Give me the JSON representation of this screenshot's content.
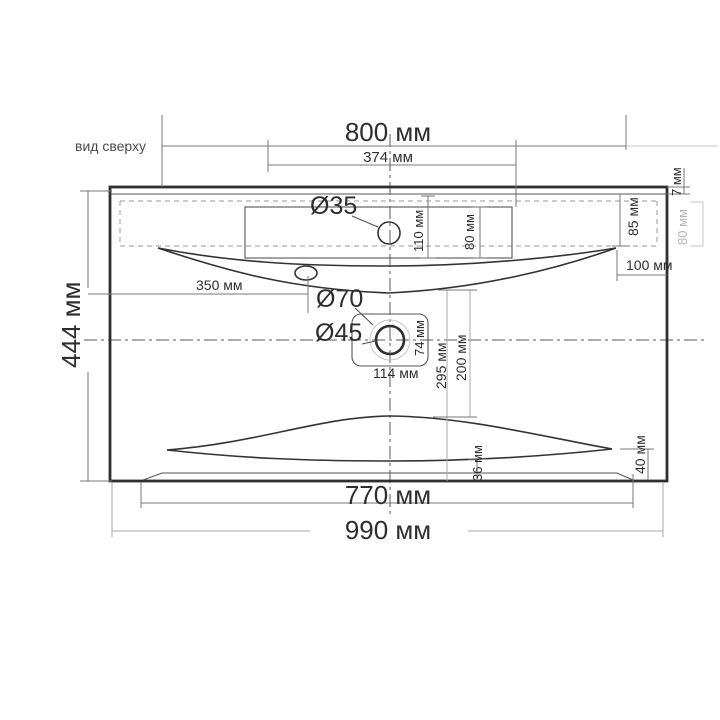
{
  "drawing": {
    "view_label": "вид сверху",
    "type": "washbasin top-view technical drawing",
    "colors": {
      "line_dark": "#2f2f2f",
      "line_muted": "#9a9a9a",
      "dim_gray_text": "#b5b5b5",
      "background": "#ffffff"
    }
  },
  "dimensions": {
    "top_width": "800 мм",
    "faucet_span": "374 мм",
    "faucet_hole_diameter": "Ø35",
    "faucet_hole_offset": "110 мм",
    "deck_depth": "80 мм",
    "back_rim_thickness": "7 мм",
    "back_ledge_depth": "85 мм",
    "side_ledge_depth": "80 мм",
    "bowl_side_gap": "100 мм",
    "overflow_offset": "350 мм",
    "drain_recess_diameter": "Ø70",
    "drain_hole_diameter": "Ø45",
    "drain_recess_height": "74 мм",
    "drain_recess_width": "114 мм",
    "bowl_to_front": "295 мм",
    "drain_to_front": "200 мм",
    "front_lip": "36 мм",
    "front_right_gap": "40 мм",
    "bottom_face_width": "770 мм",
    "overall_width": "990 мм",
    "overall_depth": "444 мм"
  }
}
